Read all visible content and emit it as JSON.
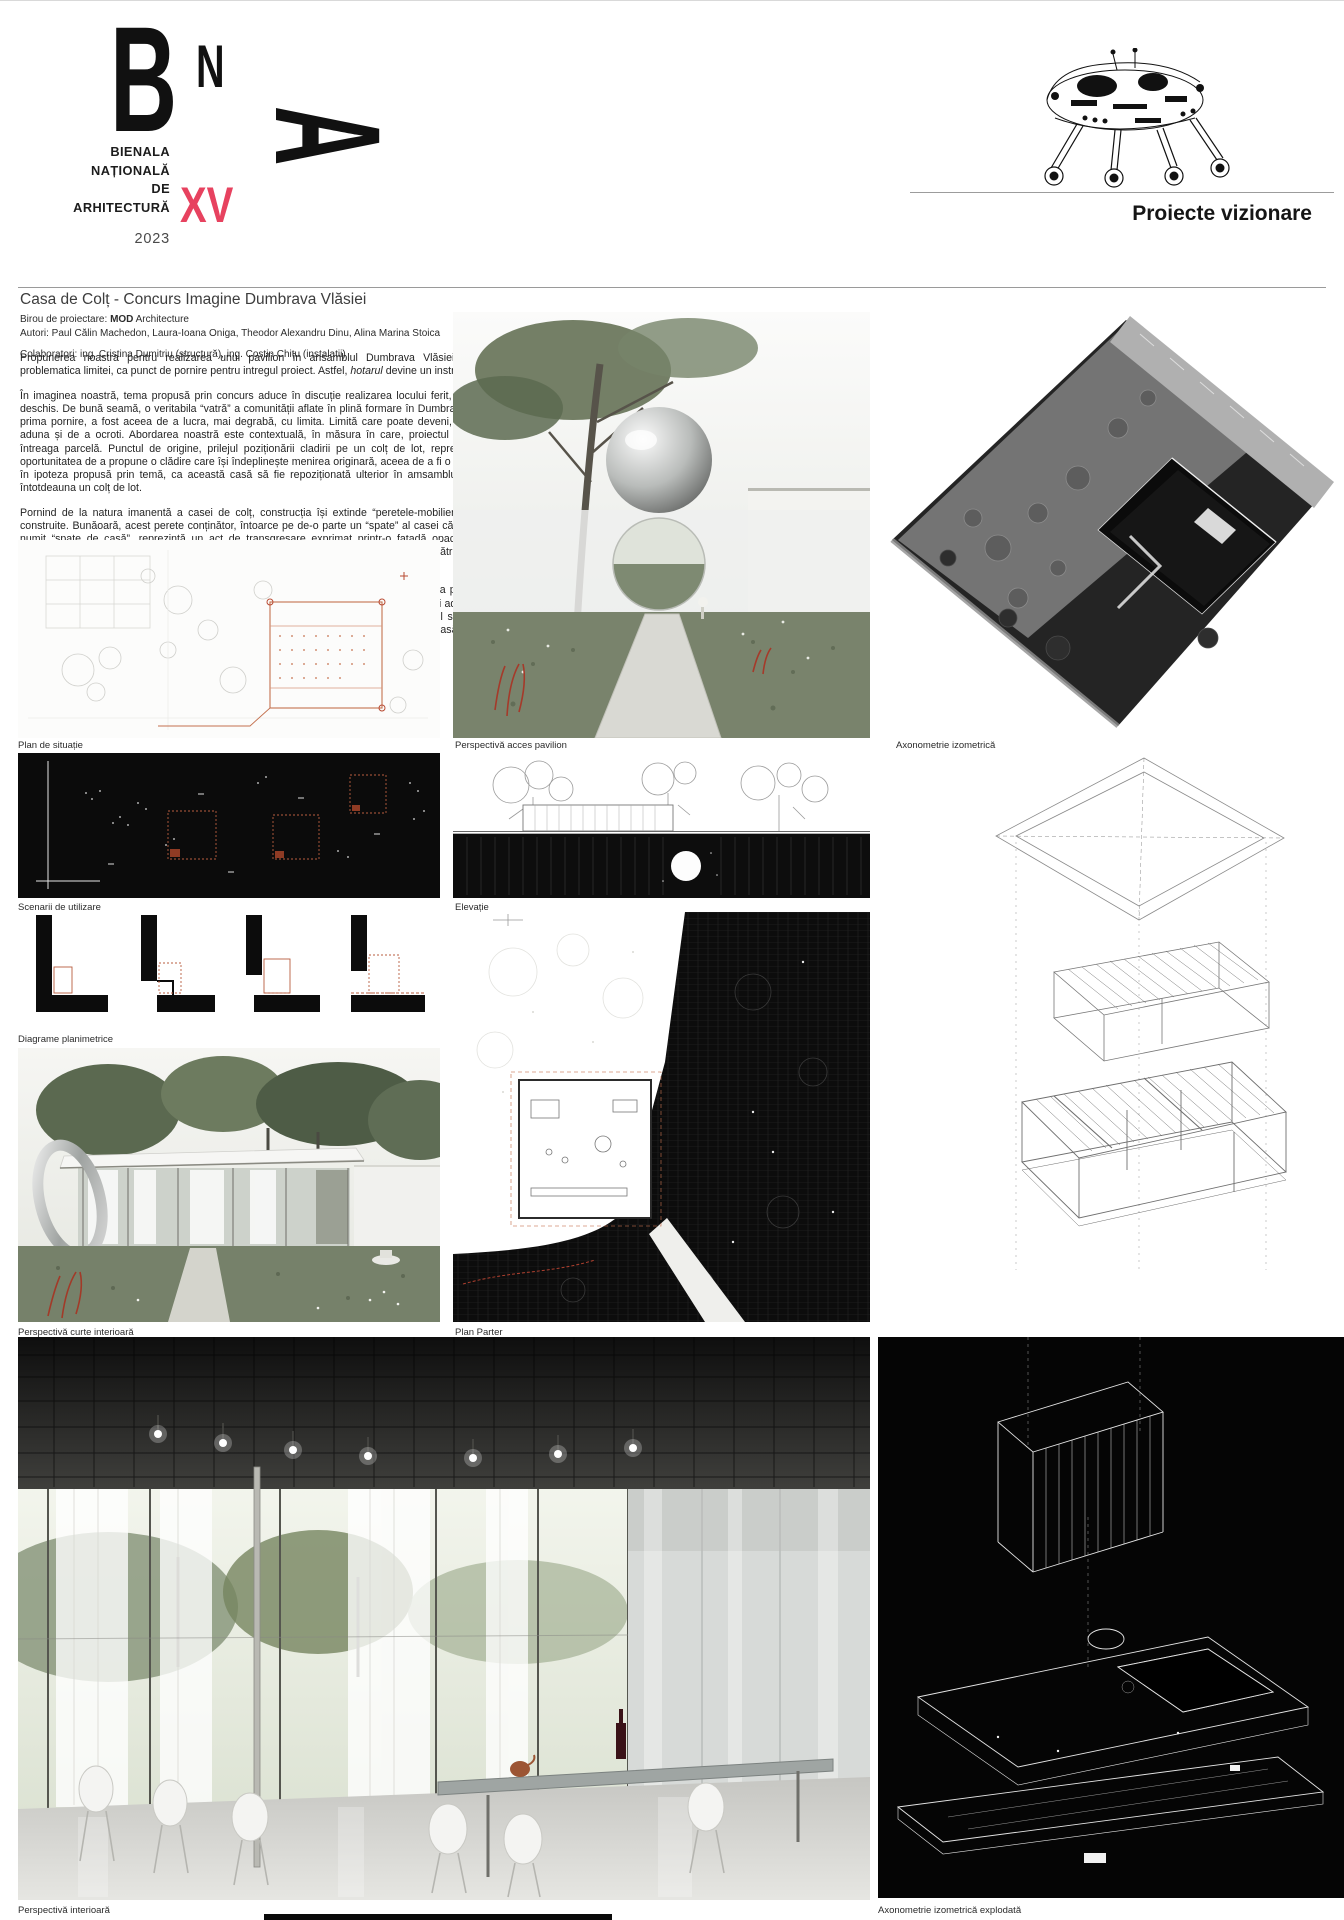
{
  "header": {
    "logo": {
      "b": "B",
      "n": "N",
      "a": "A",
      "lines": [
        "BIENALA",
        "NAȚIONALĂ",
        "DE",
        "ARHITECTURĂ"
      ],
      "edition": "XV",
      "year": "2023",
      "accent_color": "#e7425f"
    },
    "category_label": "Proiecte vizionare",
    "machine_icon": "walking-machine-illustration"
  },
  "project": {
    "title": "Casa de Colț - Concurs Imagine Dumbrava Vlăsiei",
    "office_label": "Birou de proiectare: ",
    "office_name": "MOD",
    "office_suffix": " Architecture",
    "authors": "Autori: Paul Călin Machedon, Laura-Ioana Oniga, Theodor Alexandru Dinu, Alina Marina Stoica",
    "collaborators": "Colaboratori: ing. Cristina Dumitriu (structură), ing. Costin Chițu (instalații)"
  },
  "body": {
    "p1_pre": "Propunerea noastra pentru realizarea unui pavilion în ansamblul Dumbrava Vlăsiei aduce in discuție problematica limitei, ca punct de pornire pentru intregul proiect. Astfel, ",
    "p1_italic": "hotarul",
    "p1_post": " devine un instrument de lucru.",
    "p2": "În imaginea noastră, tema propusă prin concurs aduce în discuție realizarea locului ferit, protejat, dar aflat în deschis. De bună seamă, o veritabila “vatră” a comunității aflate în plină formare în Dumbrava Vlasiei. Ca atare, prima pornire, a fost aceea de a lucra, mai degrabă, cu limita. Limită care poate deveni, în fapt, prilejul de a aduna și de a ocroti. Abordarea noastră este contextuală, în măsura în care, proiectul caută să lucreze cu întreaga parcelă. Punctul de origine, prilejul poziționării cladirii pe un colț de lot, reprezintă în ochii noștri oportunitatea de a propune o clădire care își îndeplinește menirea originară, aceea de a fi o casă de colț. Așadar, în ipoteza propusă prin temă, ca această casă să fie repoziționată ulterior în amsamblu, aceasta va ocupa întotdeauna un colț de lot.",
    "p3": "Pornind de la natura imanentă a casei de colț, construcția își extinde “peretele-mobilier” în afara ariei sale construite. Bunăoară, acest perete conținător, întoarce pe de-o parte un “spate” al casei către stradă. Acest așa numit “spate de casă”, reprezintă un act de transgresare exprimat printr-o fațadă opacă la stradă. Un act parcimonios, ce are ca scop accentuarea ulterioară a actului de devoalare a clădirii către interiorul terenului. Către vatră.",
    "p4": "Am optat ca acest perete aflat la granița dintre public și privat, care oglindește imaginea privitorului și totodată aduce în discuție problematica hotarului difuz, să definească limita ambiguă, ce separă și adună laolaltă în egală măsură. Utilizând “hotarul” ca instrument de lucru, grădina rezultată poate oferi prilejul serilor de film, sau al oricărei forme de reprezentație. O recuperare a agorei, prin marcarea carteziană și judicioasă a limitelor sale."
  },
  "captions": {
    "plan_situatie": "Plan de situație",
    "perspectiva_acces": "Perspectivă acces pavilion",
    "axonometrie": "Axonometrie izometrică",
    "scenarii": "Scenarii de utilizare",
    "elevatie": "Elevație",
    "diagrame": "Diagrame planimetrice",
    "perspectiva_curte": "Perspectivă curte interioară",
    "plan_parter": "Plan Parter",
    "perspectiva_interioara": "Perspectivă interioară",
    "axonometrie_explodata": "Axonometrie izometrică explodată"
  }
}
